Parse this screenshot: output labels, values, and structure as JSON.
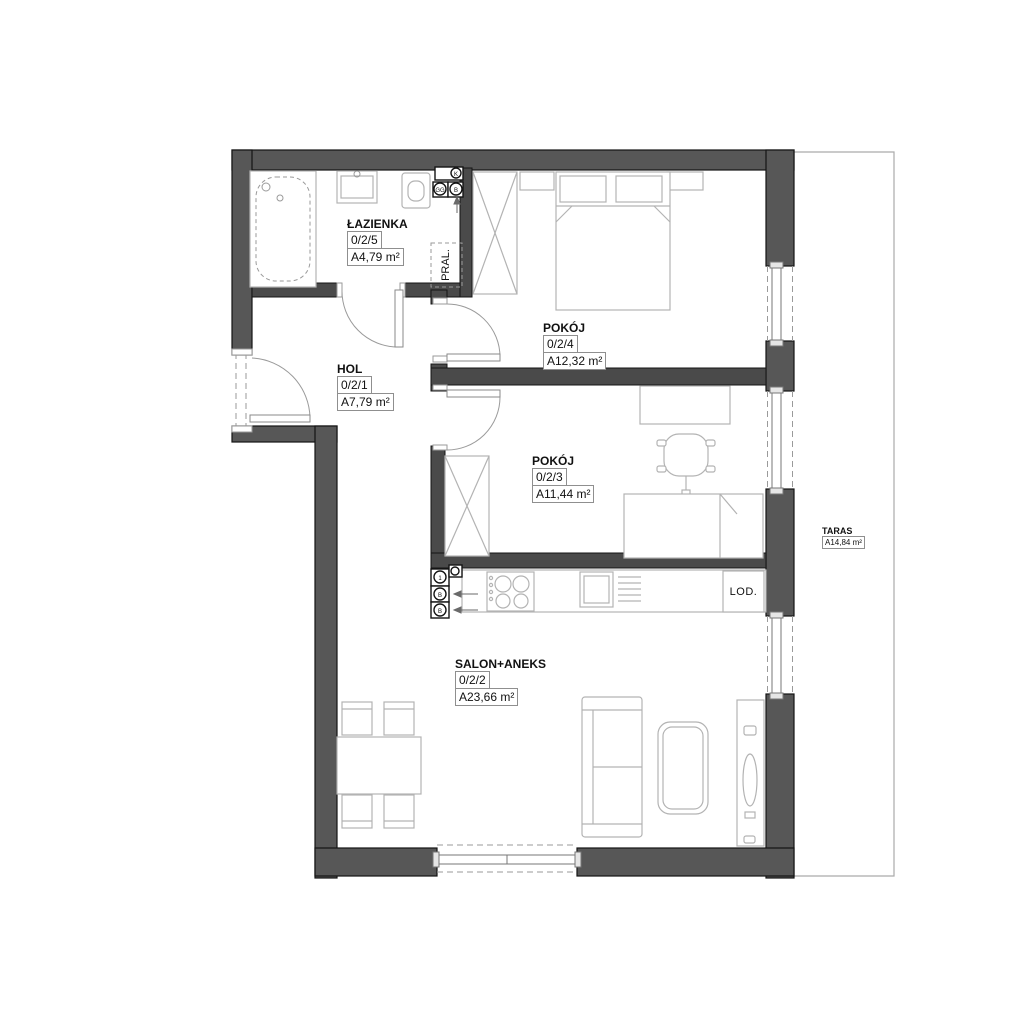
{
  "plan": {
    "rooms": {
      "bathroom": {
        "name": "ŁAZIENKA",
        "id": "0/2/5",
        "area": "A4,79 m²"
      },
      "hall": {
        "name": "HOL",
        "id": "0/2/1",
        "area": "A7,79 m²"
      },
      "bedroom_large": {
        "name": "POKÓJ",
        "id": "0/2/4",
        "area": "A12,32 m²"
      },
      "bedroom_small": {
        "name": "POKÓJ",
        "id": "0/2/3",
        "area": "A11,44 m²"
      },
      "living_room": {
        "name": "SALON+ANEKS",
        "id": "0/2/2",
        "area": "A23,66 m²"
      },
      "terrace": {
        "name": "TARAS",
        "area": "A14,84 m²"
      }
    },
    "fixtures": {
      "washing_machine": "PRAL.",
      "fridge": "LOD."
    },
    "shaft_labels": {
      "bath_top": "K",
      "bath_left": "GG",
      "bath_right": "B",
      "kitchen_top": "1",
      "kitchen_mid": "B",
      "kitchen_bottom": "B"
    },
    "colors": {
      "exterior_wall": "#575757",
      "interior_wall": "#4a4a4a",
      "furniture_line": "#b3b3b3",
      "label_text": "#111111"
    }
  }
}
